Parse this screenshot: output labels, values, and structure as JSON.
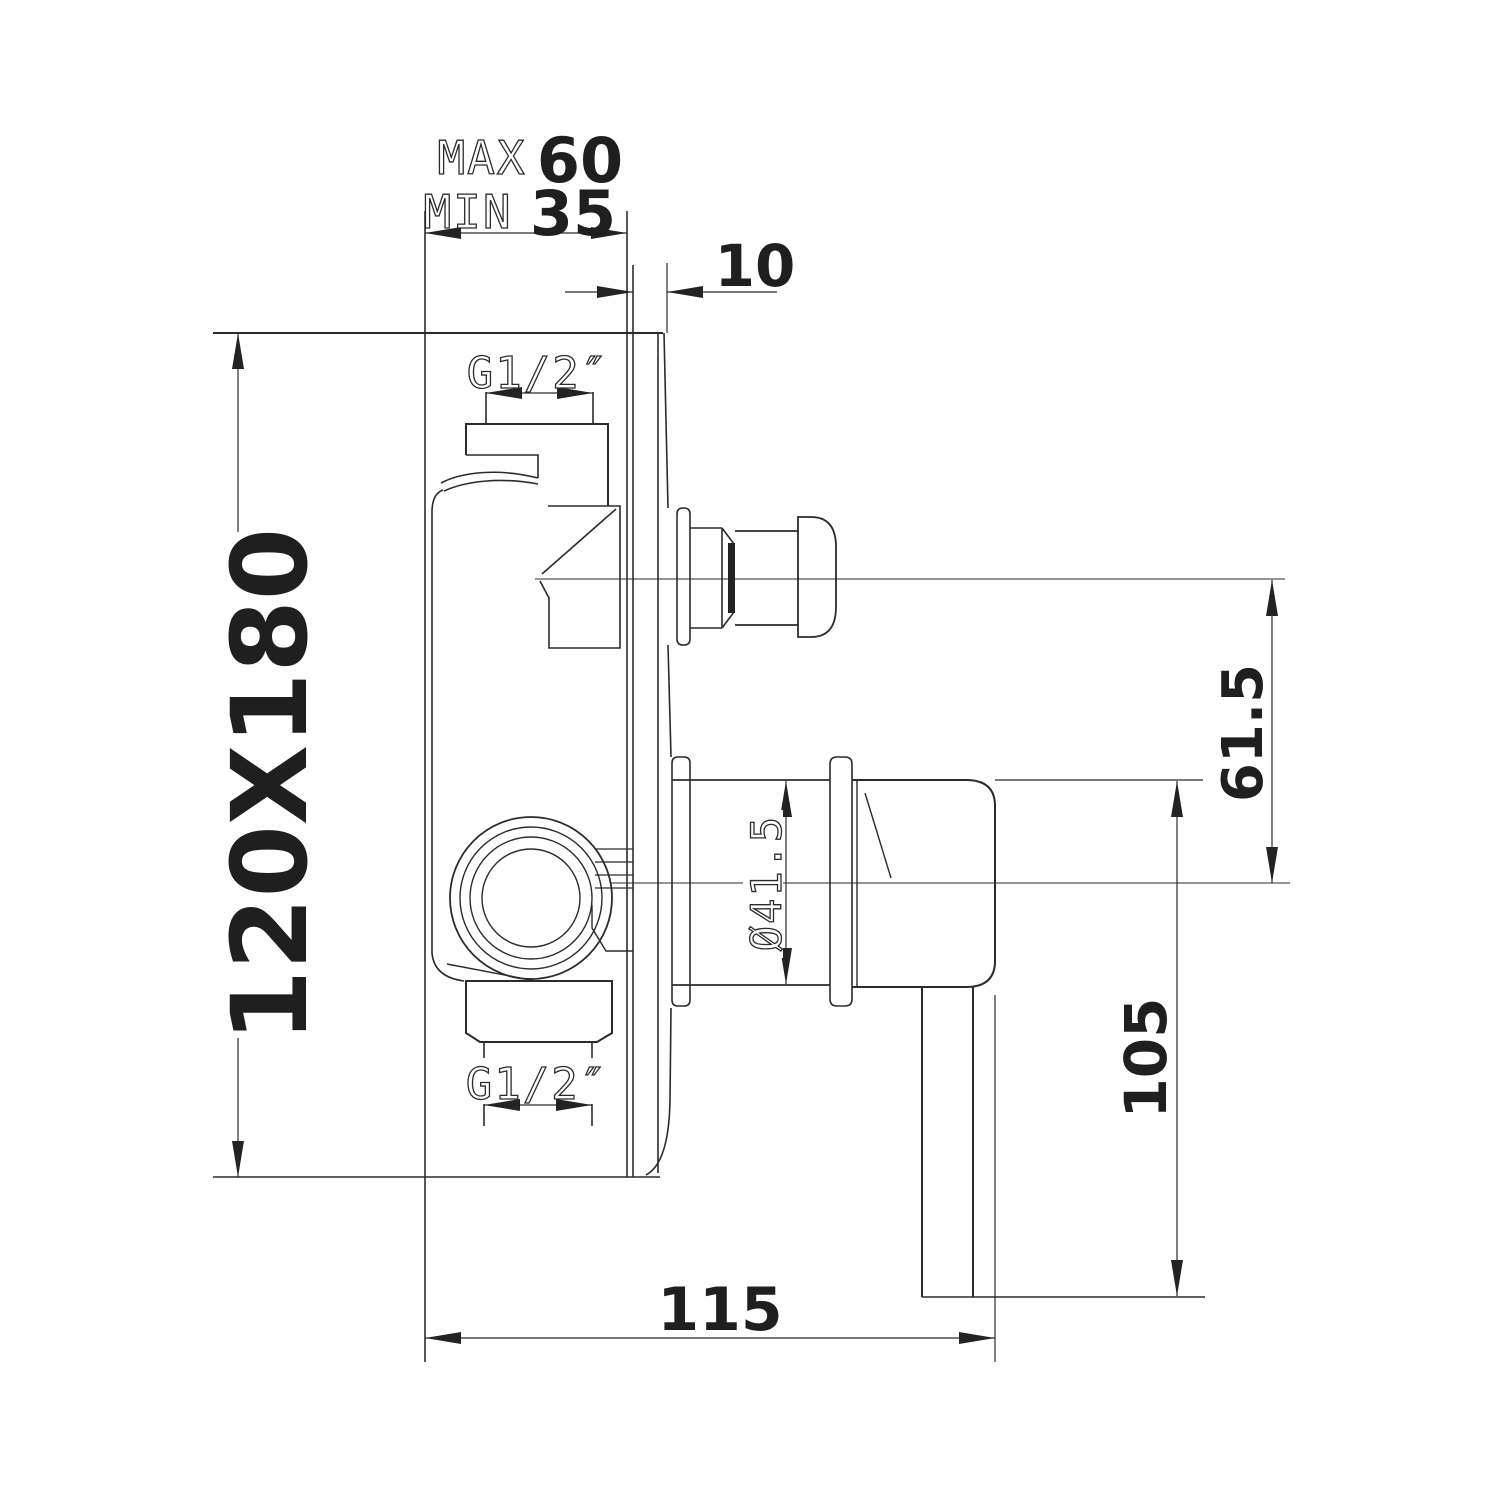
{
  "title": "Concealed shower mixer valve - side section technical drawing",
  "colors": {
    "line": "#2b2b2b",
    "text": "#1f1f1f",
    "background": "#ffffff"
  },
  "dimensions": {
    "wall_depth_max": {
      "label": "MAX",
      "value": "60"
    },
    "wall_depth_min": {
      "label": "MIN",
      "value": "35"
    },
    "plate_protrusion": {
      "value": "10"
    },
    "plate_size": {
      "value": "120X180"
    },
    "inlet_thread_top": {
      "value": "G1/2″"
    },
    "inlet_thread_bottom": {
      "value": "G1/2″"
    },
    "sleeve_diameter": {
      "value": "Ø41.5"
    },
    "knob_to_handle_axis": {
      "value": "61.5"
    },
    "handle_drop": {
      "value": "105"
    },
    "body_depth": {
      "value": "115"
    }
  }
}
